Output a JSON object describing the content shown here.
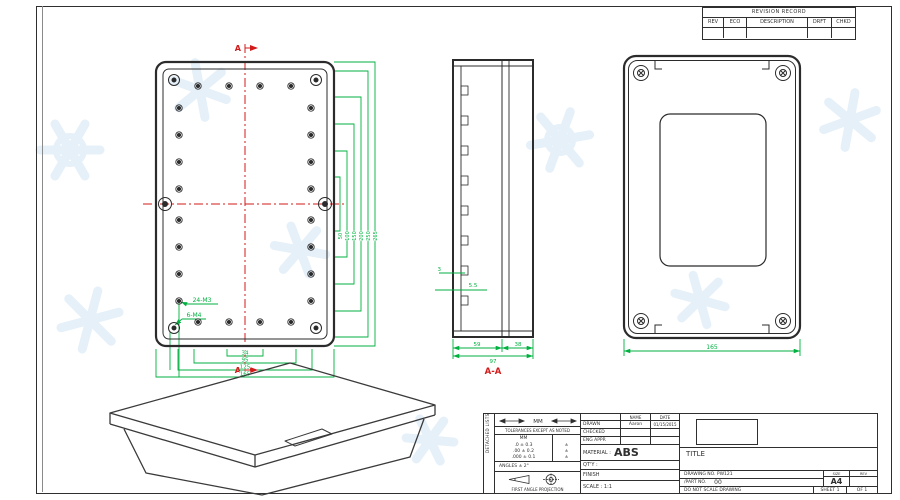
{
  "colors": {
    "dimension": "#00b140",
    "section_mark": "#d11a1a",
    "drawing_line": "#2f2f2f",
    "watermark": "#dcebf7"
  },
  "revision_table": {
    "title": "REVISION RECORD",
    "col_rev": "REV",
    "col_eco": "ECO",
    "col_desc": "DESCRIPTION",
    "col_drft": "DRFT",
    "col_chkd": "CHKD"
  },
  "front_view": {
    "section_top": "A",
    "section_bottom": "A",
    "callout_small_holes": "24-M3",
    "callout_large_holes": "6-M4",
    "dims_bottom": [
      "34",
      "95",
      "125",
      "165"
    ],
    "dims_right": [
      "50",
      "100",
      "150",
      "200",
      "250",
      "265"
    ]
  },
  "section_view": {
    "label": "A-A",
    "dim_left": "59",
    "dim_right": "38",
    "dim_total": "97",
    "dim_wall": "3",
    "dim_boss": "5.5"
  },
  "rear_view": {
    "dim_width": "165"
  },
  "title_block": {
    "edge_strip": "DETACHED LISTS",
    "units_label": "MM",
    "tol_note": "TOLERANCES EXCEPT AS NOTED",
    "tol_unit_header": "MM",
    "tol_rows": [
      ".0 ± 0.3",
      ".00 ± 0.2",
      ".000 ± 0.1"
    ],
    "tol_marks": [
      "±",
      "±",
      "±"
    ],
    "angles": "ANGLES ± 2°",
    "projection_label": "FIRST ANGLE PROJECTION",
    "name_header": "NAME",
    "date_header": "DATE",
    "drawn_label": "DRAWN",
    "drawn_name": "Aaron",
    "drawn_date": "01/15/2015",
    "checked_label": "CHECKED",
    "eng_appr_label": "ENG APPR",
    "material_label": "MATERIAL :",
    "material_value": "ABS",
    "qty_label": "QT'Y :",
    "finish_label": "FINISH",
    "scale_label": "SCALE : 1:1",
    "title_label": "TITLE",
    "drawing_no": "DRAWING NO. PW121",
    "part_no_label": "/PART NO.",
    "part_no_value": "00",
    "size_label": "SIZE",
    "size_value": "A4",
    "rev_label": "REV",
    "no_scale_note": "DO NOT SCALE DRAWING",
    "sheet_text": "SHEET 1",
    "of_text": "OF 1"
  }
}
